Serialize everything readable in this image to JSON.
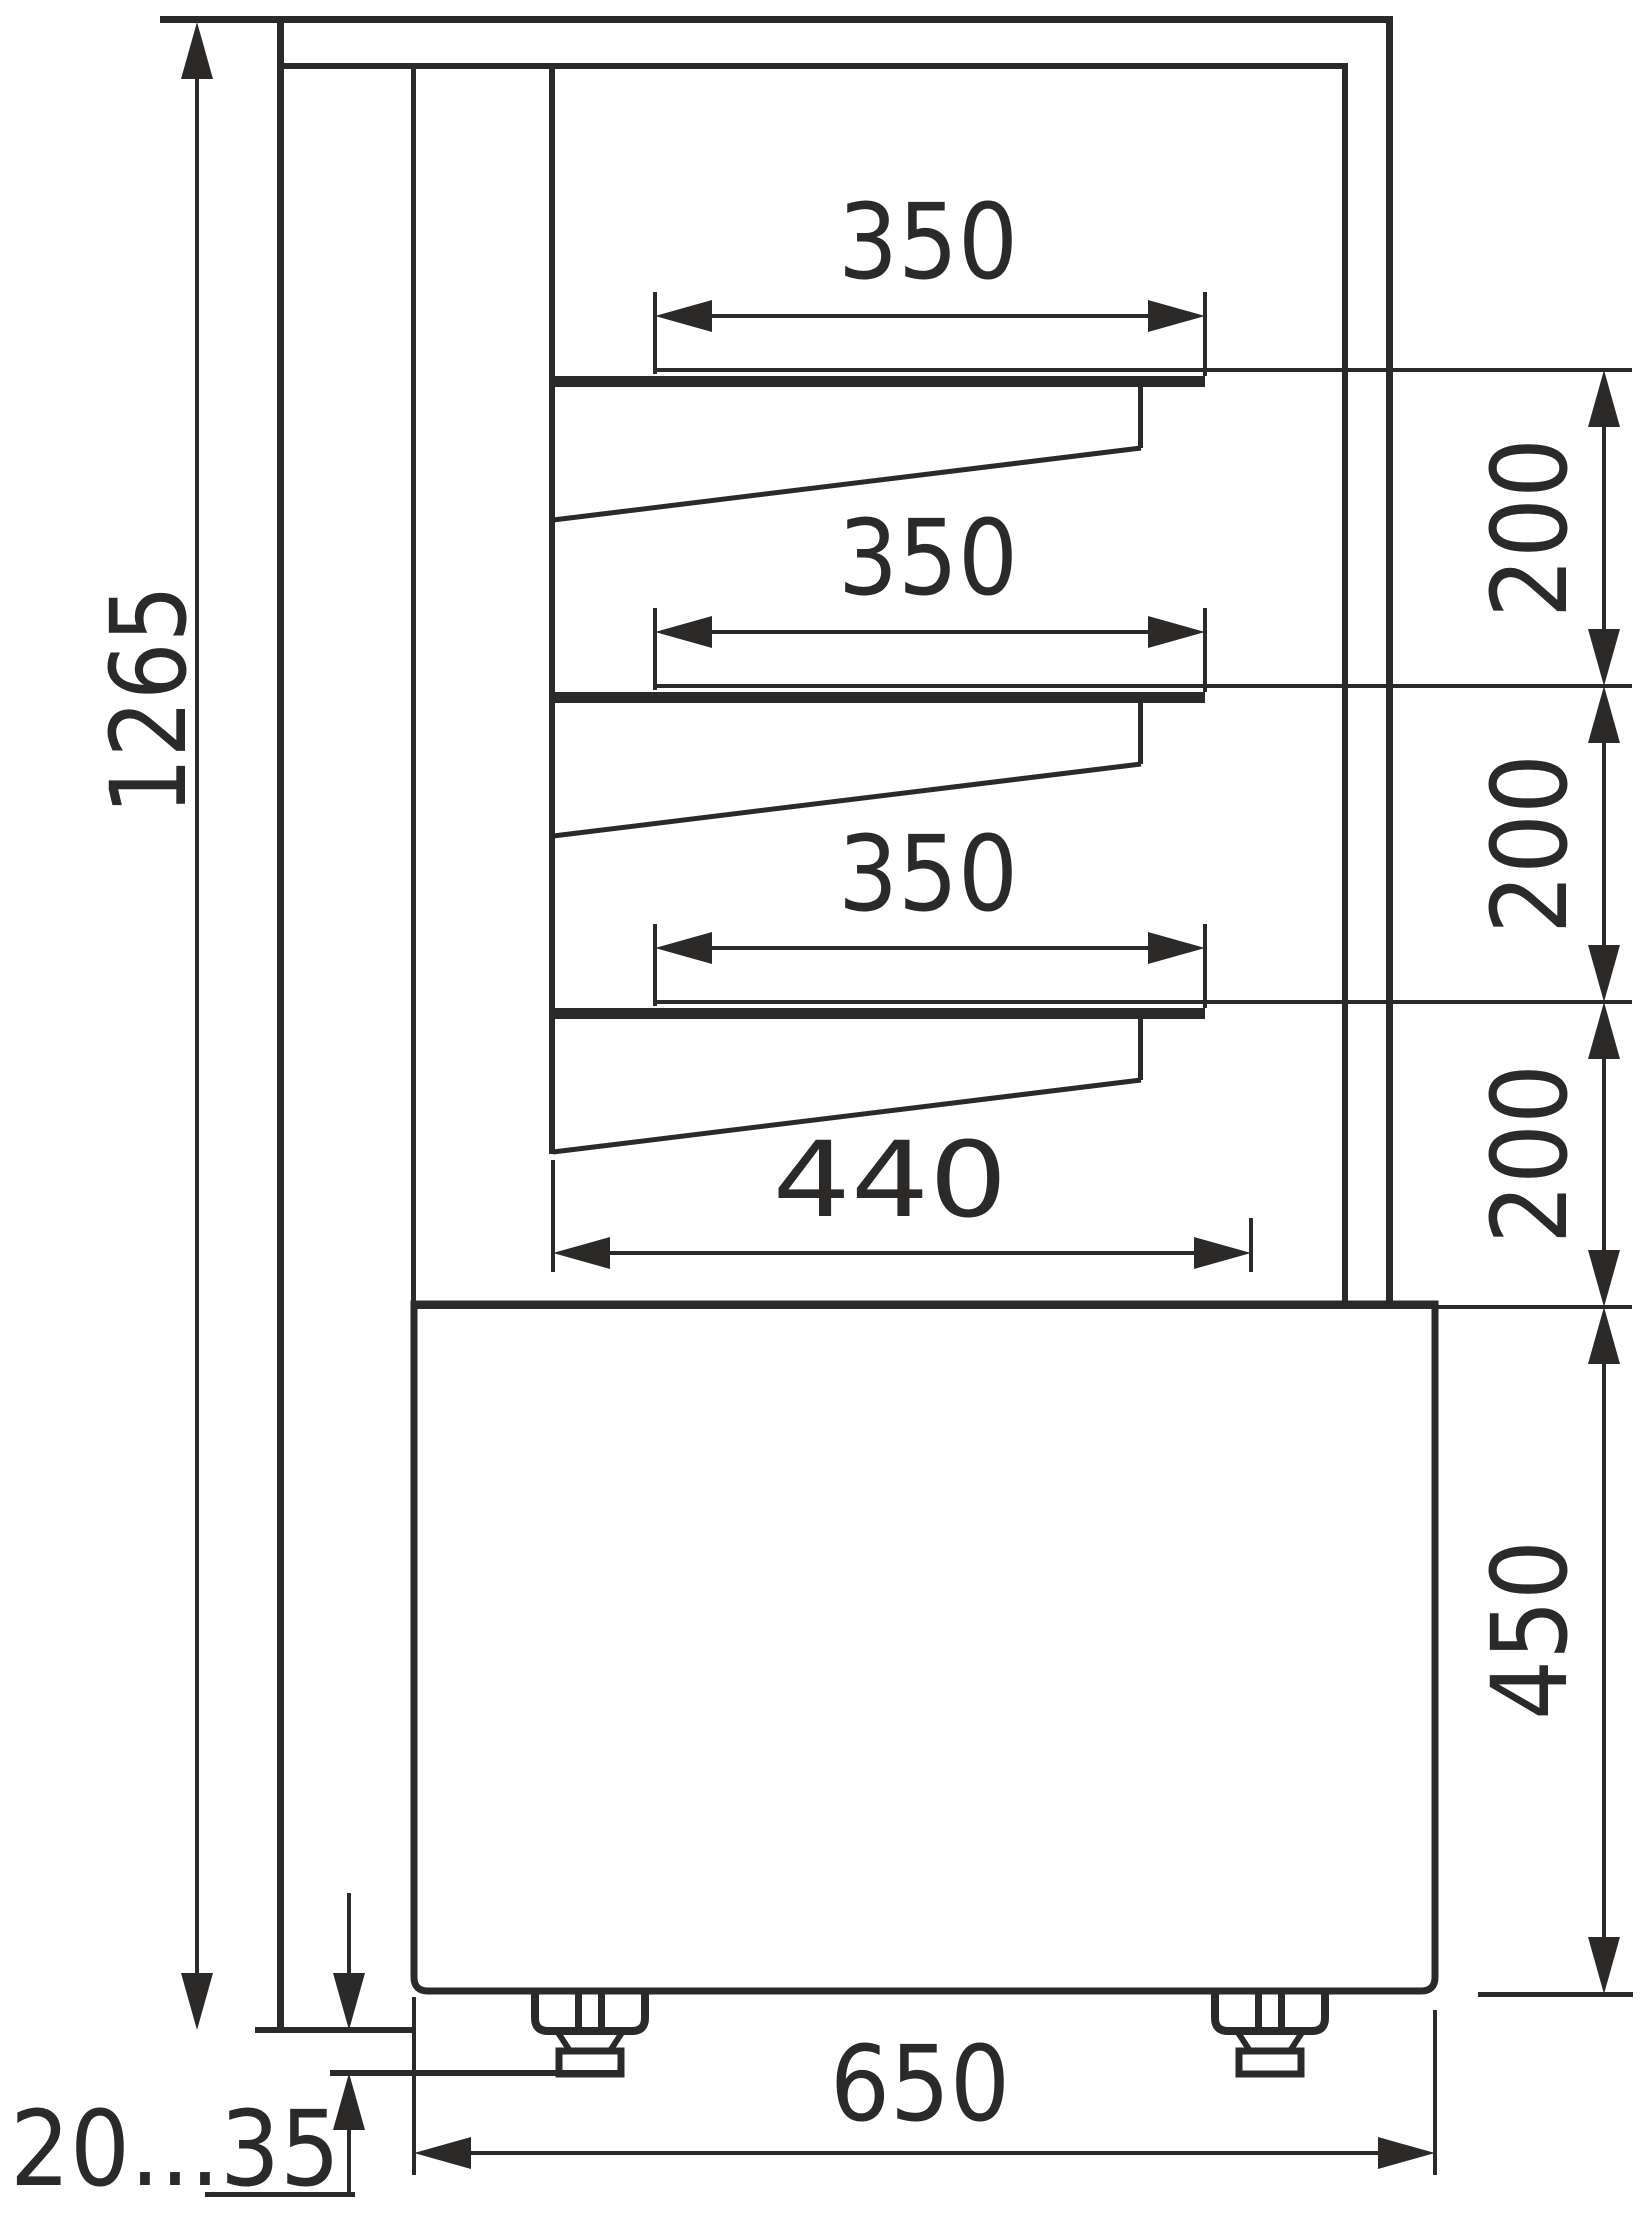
{
  "drawing": {
    "type": "technical side-view drawing of refrigerated confectionery display case",
    "ink_color": "#2b2a29",
    "background_color": "#ffffff",
    "dimensions": {
      "overall_height": "1265",
      "overall_depth": "650",
      "shelf_depths": [
        "350",
        "350",
        "350"
      ],
      "shelf_gaps": [
        "200",
        "200",
        "200"
      ],
      "bottom_shelf_depth": "440",
      "base_section_height": "450",
      "foot_adjustment_range": "20...35"
    }
  }
}
